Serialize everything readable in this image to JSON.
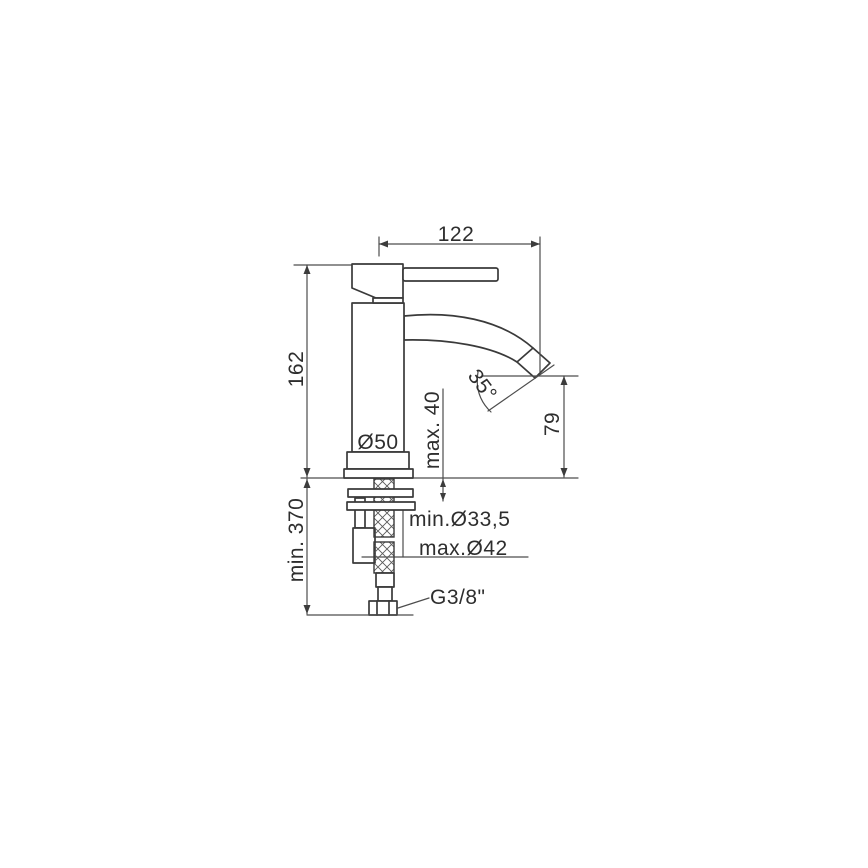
{
  "drawing": {
    "type": "technical-installation-diagram",
    "subject": "single-lever basin mixer faucet, side elevation with mounting hardware and supply hose",
    "dimensions": {
      "spout_reach": "122",
      "body_height": "162",
      "body_diameter": "Ø50",
      "max_deck_thickness": "max. 40",
      "spout_angle": "35°",
      "outlet_height": "79",
      "min_hole_diameter": "min.Ø33,5",
      "max_hole_diameter": "max.Ø42",
      "min_hose_length": "min. 370",
      "thread_size": "G3/8\""
    },
    "colors": {
      "background": "#ffffff",
      "object_line": "#3a3a3a",
      "dimension_line": "#4d4d4d",
      "text": "#2e2e2e"
    }
  }
}
